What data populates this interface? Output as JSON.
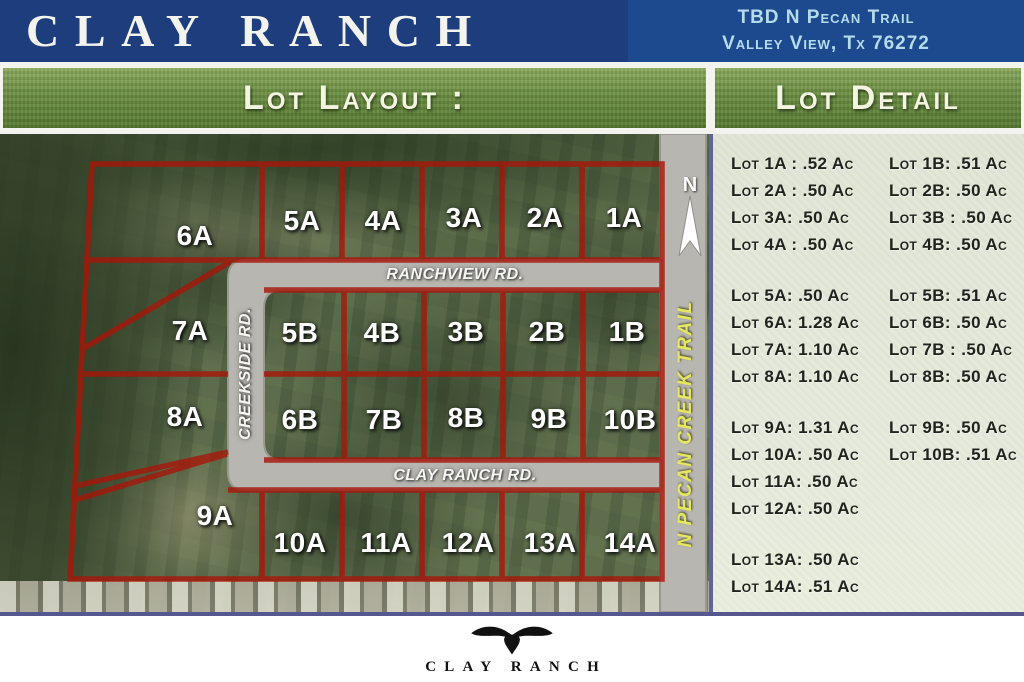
{
  "header": {
    "title": "CLAY RANCH",
    "address_line1": "TBD N Pecan Trail",
    "address_line2": "Valley View, Tx 76272"
  },
  "layout_panel": {
    "heading": "Lot Layout :"
  },
  "detail_panel": {
    "heading": "Lot Detail"
  },
  "map": {
    "north_label": "N",
    "roads": {
      "ranchview": "RANCHVIEW RD.",
      "creekside": "CREEKSIDE RD.",
      "clay_ranch": "CLAY RANCH RD.",
      "pecan_trail": "N PECAN CREEK TRAIL"
    },
    "rows": {
      "top": [
        "6A",
        "5A",
        "4A",
        "3A",
        "2A",
        "1A"
      ],
      "mid1": [
        "7A",
        "5B",
        "4B",
        "3B",
        "2B",
        "1B"
      ],
      "mid2": [
        "8A",
        "6B",
        "7B",
        "8B",
        "9B",
        "10B"
      ],
      "bottom": [
        "9A",
        "10A",
        "11A",
        "12A",
        "13A",
        "14A"
      ]
    }
  },
  "detail": {
    "groups": [
      {
        "rows": [
          {
            "a": "Lot 1A : .52 Ac",
            "b": "Lot 1B: .51 Ac"
          },
          {
            "a": "Lot 2A : .50 Ac",
            "b": "Lot 2B: .50 Ac"
          },
          {
            "a": "Lot 3A: .50 Ac",
            "b": "Lot 3B : .50 Ac"
          },
          {
            "a": "Lot 4A : .50 Ac",
            "b": "Lot 4B: .50 Ac"
          }
        ]
      },
      {
        "rows": [
          {
            "a": "Lot 5A: .50 Ac",
            "b": "Lot 5B: .51 Ac"
          },
          {
            "a": "Lot 6A: 1.28 Ac",
            "b": "Lot 6B: .50 Ac"
          },
          {
            "a": "Lot 7A: 1.10 Ac",
            "b": "Lot 7B : .50 Ac"
          },
          {
            "a": "Lot 8A: 1.10 Ac",
            "b": "Lot 8B: .50 Ac"
          }
        ]
      },
      {
        "rows": [
          {
            "a": "Lot 9A: 1.31 Ac",
            "b": "Lot 9B: .50 Ac"
          },
          {
            "a": "Lot 10A: .50 Ac",
            "b": "Lot 10B: .51 Ac"
          },
          {
            "a": "Lot 11A: .50 Ac",
            "b": ""
          },
          {
            "a": "Lot 12A: .50 Ac",
            "b": ""
          }
        ]
      },
      {
        "rows": [
          {
            "a": "Lot 13A: .50 Ac",
            "b": ""
          },
          {
            "a": "Lot 14A: .51 Ac",
            "b": ""
          }
        ]
      }
    ]
  },
  "footer": {
    "logo_text": "CLAY RANCH"
  },
  "colors": {
    "header_blue": "#1e3d7d",
    "address_blue": "#1d4a8e",
    "address_text": "#b5dcec",
    "banner_green": "#6d9043",
    "paper": "#e1e5d6",
    "lot_line_red": "#ff2a12",
    "road_gray": "#b7b6b0",
    "trail_text_yellow": "#e6e75f",
    "border_purple": "#57578f"
  }
}
